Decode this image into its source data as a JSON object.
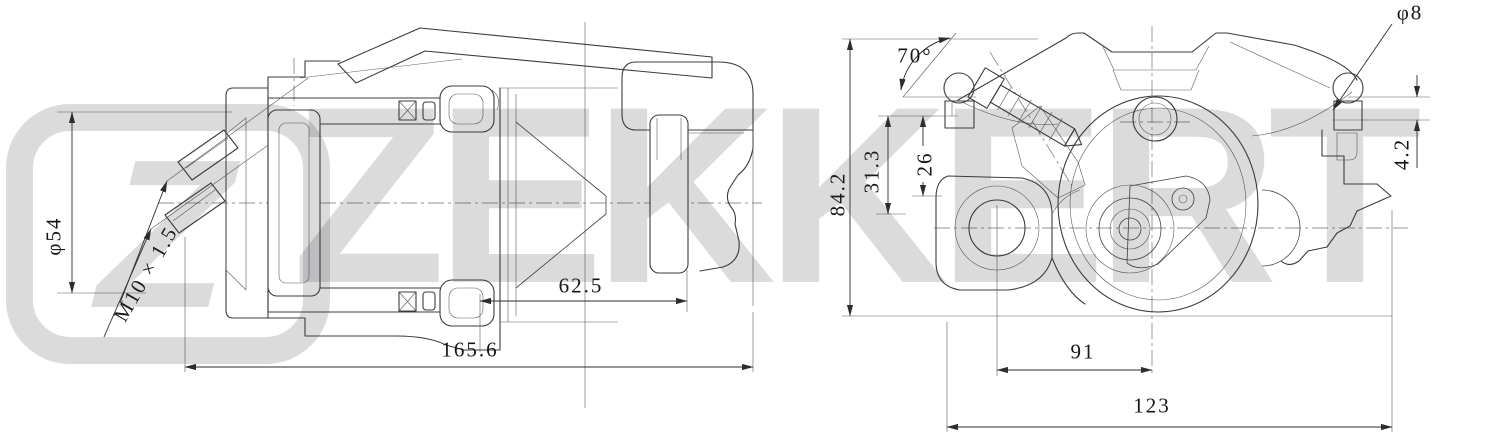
{
  "watermark": {
    "brand": "ZEKKERT",
    "logo_letter": "Z",
    "tint": "#d9d9da"
  },
  "drawing": {
    "line_color": "#3c3c3c",
    "background": "#ffffff"
  },
  "labels": {
    "dia54": "φ54",
    "thread": "M10 × 1.5",
    "len62_5": "62.5",
    "len165_6": "165.6",
    "h84_2": "84.2",
    "h31_3": "31.3",
    "h26": "26",
    "angle70": "70°",
    "dia8": "φ8",
    "h4_2": "4.2",
    "len91": "91",
    "len123": "123"
  }
}
